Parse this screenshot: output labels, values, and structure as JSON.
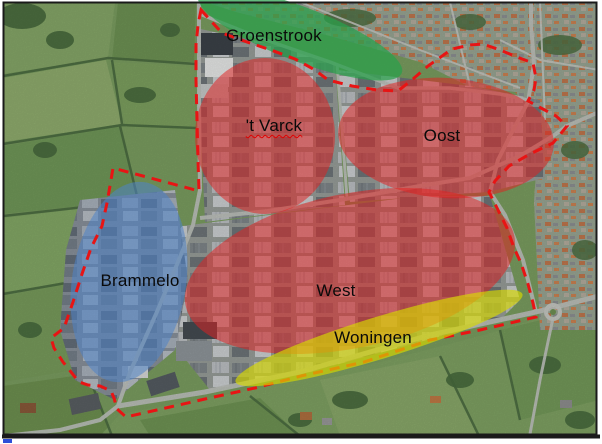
{
  "map": {
    "type": "annotated-aerial-map",
    "frame_color": "#1a1a1a",
    "page_background": "#ffffff",
    "corner_mark_color": "#2e4fd8"
  },
  "zones": [
    {
      "id": "groenstrook",
      "label": "Groenstrook",
      "color": "#28a14b",
      "opacity": 0.72,
      "cx": 300,
      "cy": 34,
      "rx": 109,
      "ry": 27,
      "rotation": 21,
      "label_x": 274,
      "label_y": 36
    },
    {
      "id": "t-varck",
      "label": "'t Varck",
      "color": "#e32020",
      "opacity": 0.52,
      "cx": 265,
      "cy": 136,
      "rx": 70,
      "ry": 78,
      "rotation": 0,
      "label_x": 274,
      "label_y": 126,
      "misspelled": true
    },
    {
      "id": "oost",
      "label": "Oost",
      "color": "#e32020",
      "opacity": 0.52,
      "cx": 446,
      "cy": 138,
      "rx": 108,
      "ry": 60,
      "rotation": 4,
      "label_x": 442,
      "label_y": 136
    },
    {
      "id": "west",
      "label": "West",
      "color": "#e32020",
      "opacity": 0.52,
      "cx": 350,
      "cy": 271,
      "rx": 168,
      "ry": 77,
      "rotation": -12,
      "label_x": 336,
      "label_y": 291
    },
    {
      "id": "brammelo",
      "label": "Brammelo",
      "color": "#4e84c8",
      "opacity": 0.55,
      "cx": 129,
      "cy": 282,
      "rx": 57,
      "ry": 101,
      "rotation": 9,
      "label_x": 140,
      "label_y": 281
    },
    {
      "id": "woningen",
      "label": "Woningen",
      "color": "#d7d900",
      "opacity": 0.66,
      "cx": 379,
      "cy": 338,
      "rx": 150,
      "ry": 21,
      "rotation": -17,
      "label_x": 373,
      "label_y": 338,
      "above_boundary": true
    }
  ],
  "boundary": {
    "color": "#e81414",
    "stroke_width": 3,
    "dash": "10 7",
    "points": [
      [
        201,
        10
      ],
      [
        222,
        33
      ],
      [
        247,
        42
      ],
      [
        271,
        50
      ],
      [
        295,
        59
      ],
      [
        315,
        70
      ],
      [
        328,
        80
      ],
      [
        352,
        86
      ],
      [
        377,
        90
      ],
      [
        398,
        91
      ],
      [
        413,
        79
      ],
      [
        428,
        66
      ],
      [
        452,
        49
      ],
      [
        470,
        45
      ],
      [
        483,
        44
      ],
      [
        500,
        50
      ],
      [
        517,
        57
      ],
      [
        533,
        63
      ],
      [
        536,
        78
      ],
      [
        534,
        90
      ],
      [
        528,
        101
      ],
      [
        541,
        108
      ],
      [
        556,
        116
      ],
      [
        567,
        126
      ],
      [
        553,
        143
      ],
      [
        530,
        154
      ],
      [
        509,
        166
      ],
      [
        495,
        181
      ],
      [
        489,
        192
      ],
      [
        499,
        212
      ],
      [
        507,
        228
      ],
      [
        514,
        248
      ],
      [
        521,
        263
      ],
      [
        528,
        284
      ],
      [
        533,
        303
      ],
      [
        536,
        317
      ],
      [
        480,
        330
      ],
      [
        430,
        340
      ],
      [
        364,
        362
      ],
      [
        301,
        376
      ],
      [
        255,
        388
      ],
      [
        205,
        399
      ],
      [
        170,
        407
      ],
      [
        126,
        417
      ],
      [
        117,
        409
      ],
      [
        114,
        398
      ],
      [
        111,
        391
      ],
      [
        100,
        386
      ],
      [
        88,
        385
      ],
      [
        79,
        382
      ],
      [
        63,
        362
      ],
      [
        54,
        348
      ],
      [
        51,
        338
      ],
      [
        64,
        328
      ],
      [
        73,
        302
      ],
      [
        82,
        274
      ],
      [
        91,
        248
      ],
      [
        102,
        226
      ],
      [
        107,
        203
      ],
      [
        111,
        180
      ],
      [
        113,
        168
      ],
      [
        199,
        191
      ],
      [
        198,
        160
      ],
      [
        197,
        120
      ],
      [
        196,
        80
      ],
      [
        196,
        45
      ],
      [
        198,
        25
      ]
    ]
  }
}
